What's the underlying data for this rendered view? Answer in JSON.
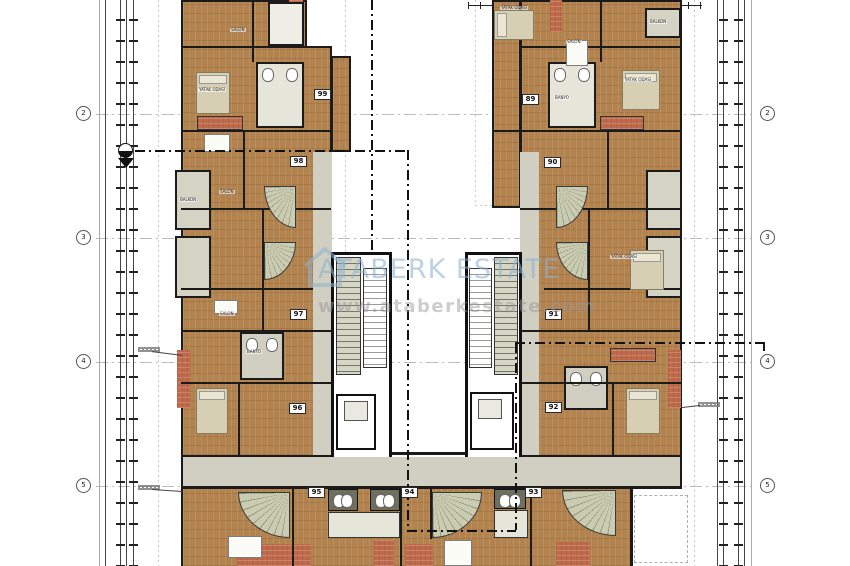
{
  "watermark": {
    "brand": "ATABERK ESTATE",
    "website": "www.ataberkestate.com",
    "brand_color": "#8cb0d2",
    "website_color": "#9a9a9a",
    "logo": "house-outline-icon"
  },
  "grid": {
    "rows": [
      "2",
      "3",
      "4",
      "5"
    ]
  },
  "units": [
    "99",
    "98",
    "97",
    "96",
    "95",
    "94",
    "93",
    "92",
    "91",
    "90",
    "89"
  ],
  "room_labels": [
    "SALON",
    "YATAK ODASI",
    "YATAK ODASI",
    "SALON",
    "BALKON",
    "YATAK ODASI",
    "BANYO",
    "SALON",
    "BALKON",
    "SALON",
    "YATAK ODASI",
    "BANYO"
  ],
  "palette": {
    "wood_floor": "#b3834f",
    "tile_terracotta": "#c06a4c",
    "wet_area": "#d0cfc1",
    "wall": "#1b1b1b",
    "background": "#ffffff",
    "grid_line": "#bcbcbc"
  }
}
